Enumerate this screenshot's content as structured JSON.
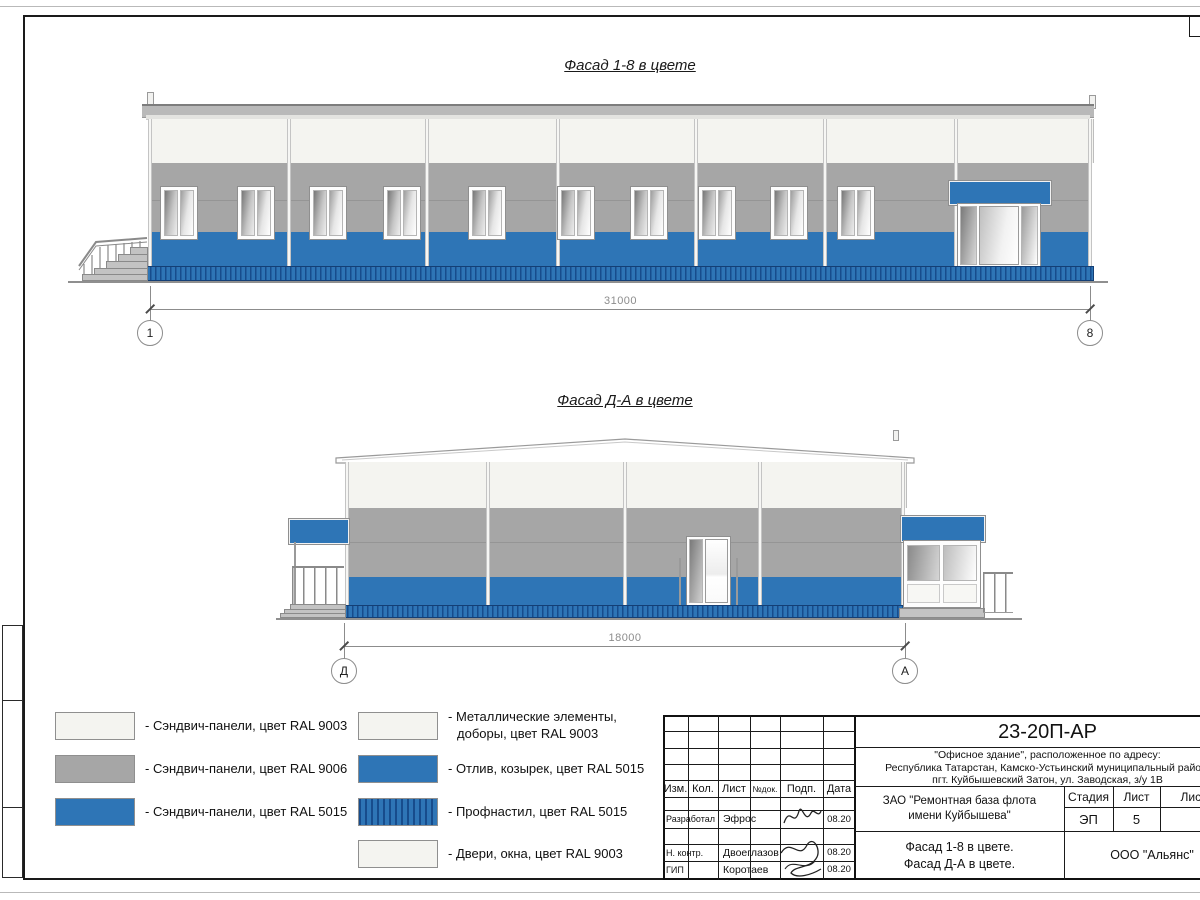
{
  "figures": {
    "facade18": {
      "title": "Фасад 1-8 в цвете",
      "dimension": "31000",
      "axis_left": "1",
      "axis_right": "8"
    },
    "facadeDA": {
      "title": "Фасад Д-А в цвете",
      "dimension": "18000",
      "axis_left": "Д",
      "axis_right": "А"
    }
  },
  "legend": {
    "left": [
      {
        "label": "- Сэндвич-панели, цвет RAL 9003",
        "color_key": "ral9003"
      },
      {
        "label": "- Сэндвич-панели, цвет RAL 9006",
        "color_key": "ral9006"
      },
      {
        "label": "- Сэндвич-панели, цвет RAL 5015",
        "color_key": "ral5015"
      }
    ],
    "right": [
      {
        "label": "- Металлические элементы,\nдоборы, цвет RAL 9003",
        "color_key": "ral9003"
      },
      {
        "label": "- Отлив, козырек, цвет RAL 5015",
        "color_key": "ral5015"
      },
      {
        "label": "- Профнастил, цвет RAL 5015",
        "color_key": "ral5015_profiled"
      },
      {
        "label": "- Двери, окна, цвет RAL 9003",
        "color_key": "ral9003"
      }
    ]
  },
  "colors": {
    "ral9003": "#f4f4f0",
    "ral9006": "#a6a6a6",
    "ral5015": "#2e75b6",
    "corrugated_dark": "#174c8c"
  },
  "titleblock": {
    "doc_code": "23-20П-АР",
    "address_line1": "\"Офисное здание\", расположенное по адресу:",
    "address_line2": "Республика Татарстан, Камско-Устьинский муниципальный район,",
    "address_line3": "пгт. Куйбышевский Затон, ул. Заводская, з/у 1В",
    "columns": {
      "izm": "Изм.",
      "kol": "Кол.",
      "list": "Лист",
      "ndok": "№док.",
      "podp": "Подп.",
      "data": "Дата"
    },
    "rows": [
      {
        "role": "Разработал",
        "name": "Эфрос",
        "date": "08.20"
      },
      {
        "role": "Н. контр.",
        "name": "Двоеглазов",
        "date": "08.20"
      },
      {
        "role": "ГИП",
        "name": "Коротаев",
        "date": "08.20"
      }
    ],
    "object_line1": "ЗАО \"Ремонтная база флота",
    "object_line2": "имени Куйбышева\"",
    "stage_label": "Стадия",
    "sheet_label": "Лист",
    "sheets_label": "Листов",
    "stage_value": "ЭП",
    "sheet_value": "5",
    "content_line1": "Фасад 1-8 в цвете.",
    "content_line2": "Фасад Д-А в цвете.",
    "org": "ООО \"Альянс\""
  }
}
